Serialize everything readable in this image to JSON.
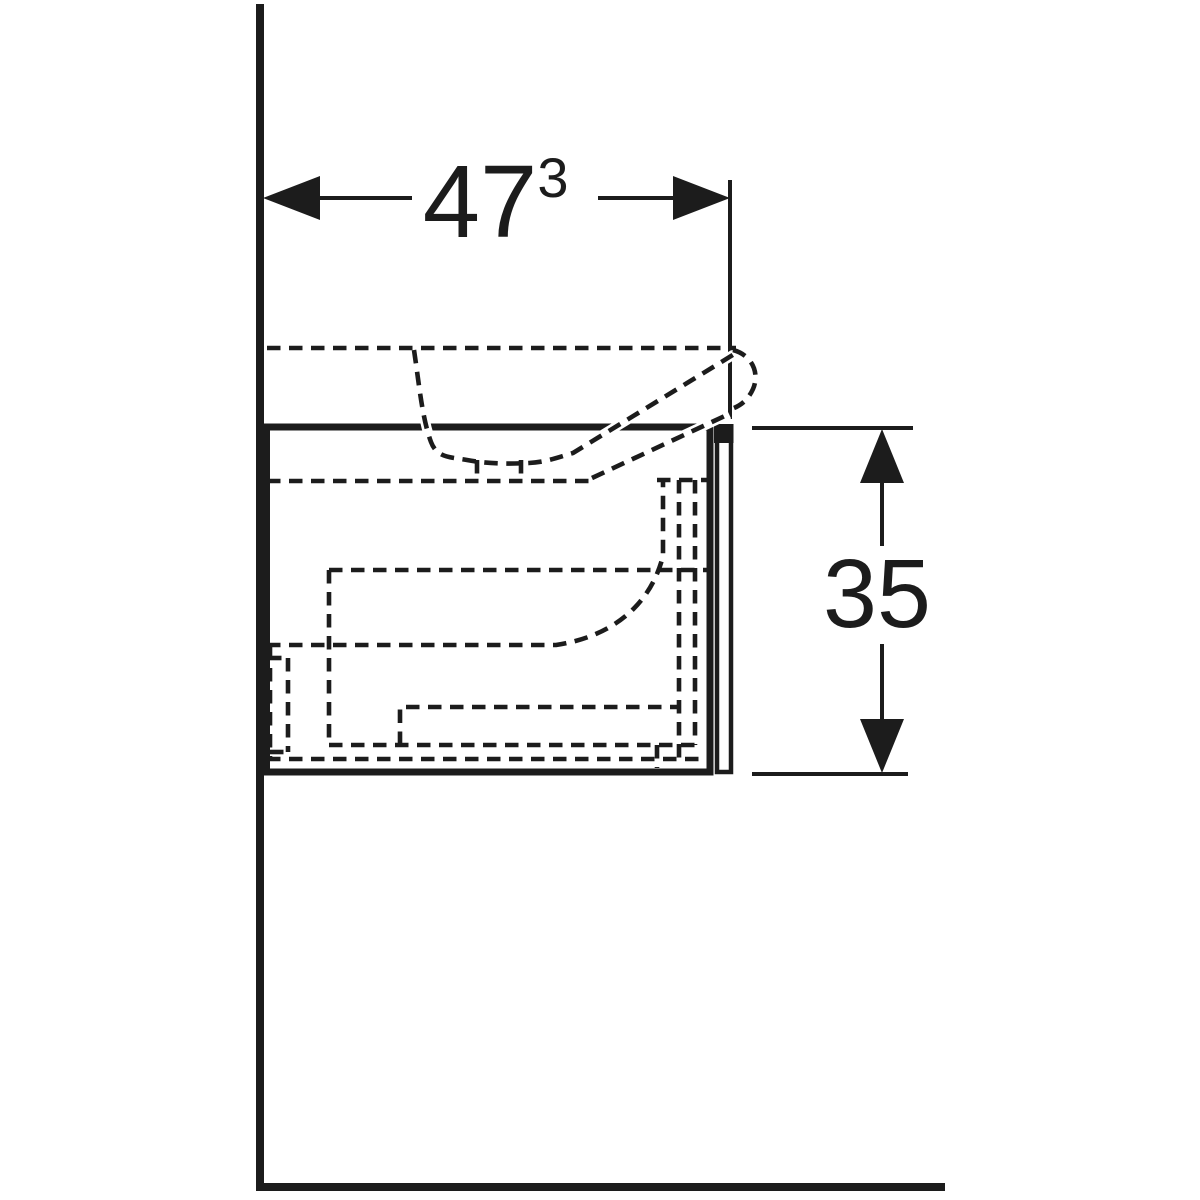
{
  "meta": {
    "drawing_type": "vanity-cabinet-side-elevation",
    "background_color": "#ffffff",
    "ink_color": "#1c1c1c"
  },
  "dimensions": {
    "width": {
      "value": "47",
      "superscript": "3"
    },
    "height": {
      "value": "35"
    }
  }
}
